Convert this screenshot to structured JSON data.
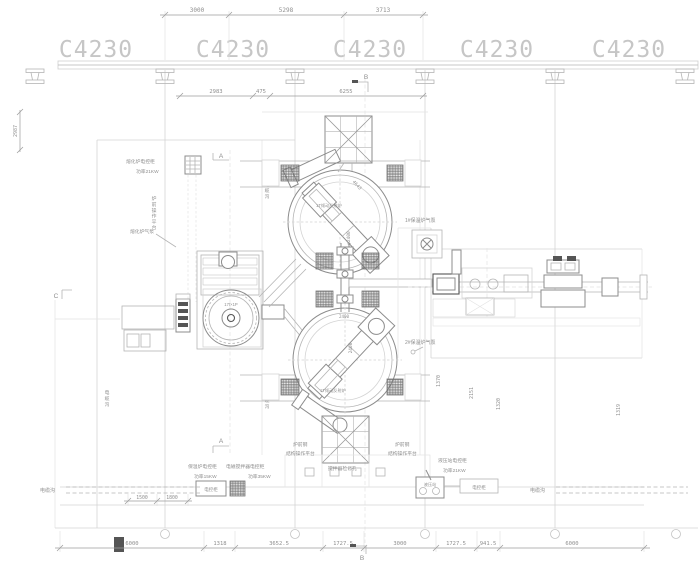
{
  "bays": [
    "C4230",
    "C4230",
    "C4230",
    "C4230",
    "C4230"
  ],
  "dims": {
    "top": [
      "3000",
      "5298",
      "3713"
    ],
    "upper": [
      "2983",
      "475",
      "6255"
    ],
    "bottom": [
      "6000",
      "1318",
      "3652.5",
      "1727.5",
      "3000",
      "1727.5",
      "941.5",
      "6000"
    ],
    "small": [
      "1500",
      "1800"
    ],
    "left_v": "2987",
    "right_v": [
      "1370",
      "2151",
      "1320",
      "1319"
    ],
    "lance": "4643",
    "dia1": "φ2400",
    "dia2": "2400"
  },
  "labels": {
    "melt_cabinet": "熔化炉电控柜",
    "melt_power": "功率21KW",
    "melt_pump": "熔化炉气泵",
    "platform_side": "炉前操作平台",
    "cable": "电缆沟",
    "furnace1": "1T倾动反射炉",
    "furnace2": "1T倾动反射炉",
    "blower": "17t×1P",
    "pump1": "1#保温炉气泵",
    "pump2": "2#保温炉气泵",
    "hold_cabinet": "保温炉电控柜",
    "hold_power": "功率15KW",
    "stir_cabinet": "电磁搅拌器电控柜",
    "stir_power": "功率35KW",
    "cabinet_box": "电控柜",
    "platform_l1": "炉前钢",
    "platform_l2": "结构操作平台",
    "stir_hole": "搅拌器检修孔",
    "hyd_cabinet": "液压站电控柜",
    "hyd_power": "功率21KW",
    "hyd_station": "液压站"
  },
  "markers": {
    "a": "A",
    "b": "B",
    "c": "C"
  }
}
